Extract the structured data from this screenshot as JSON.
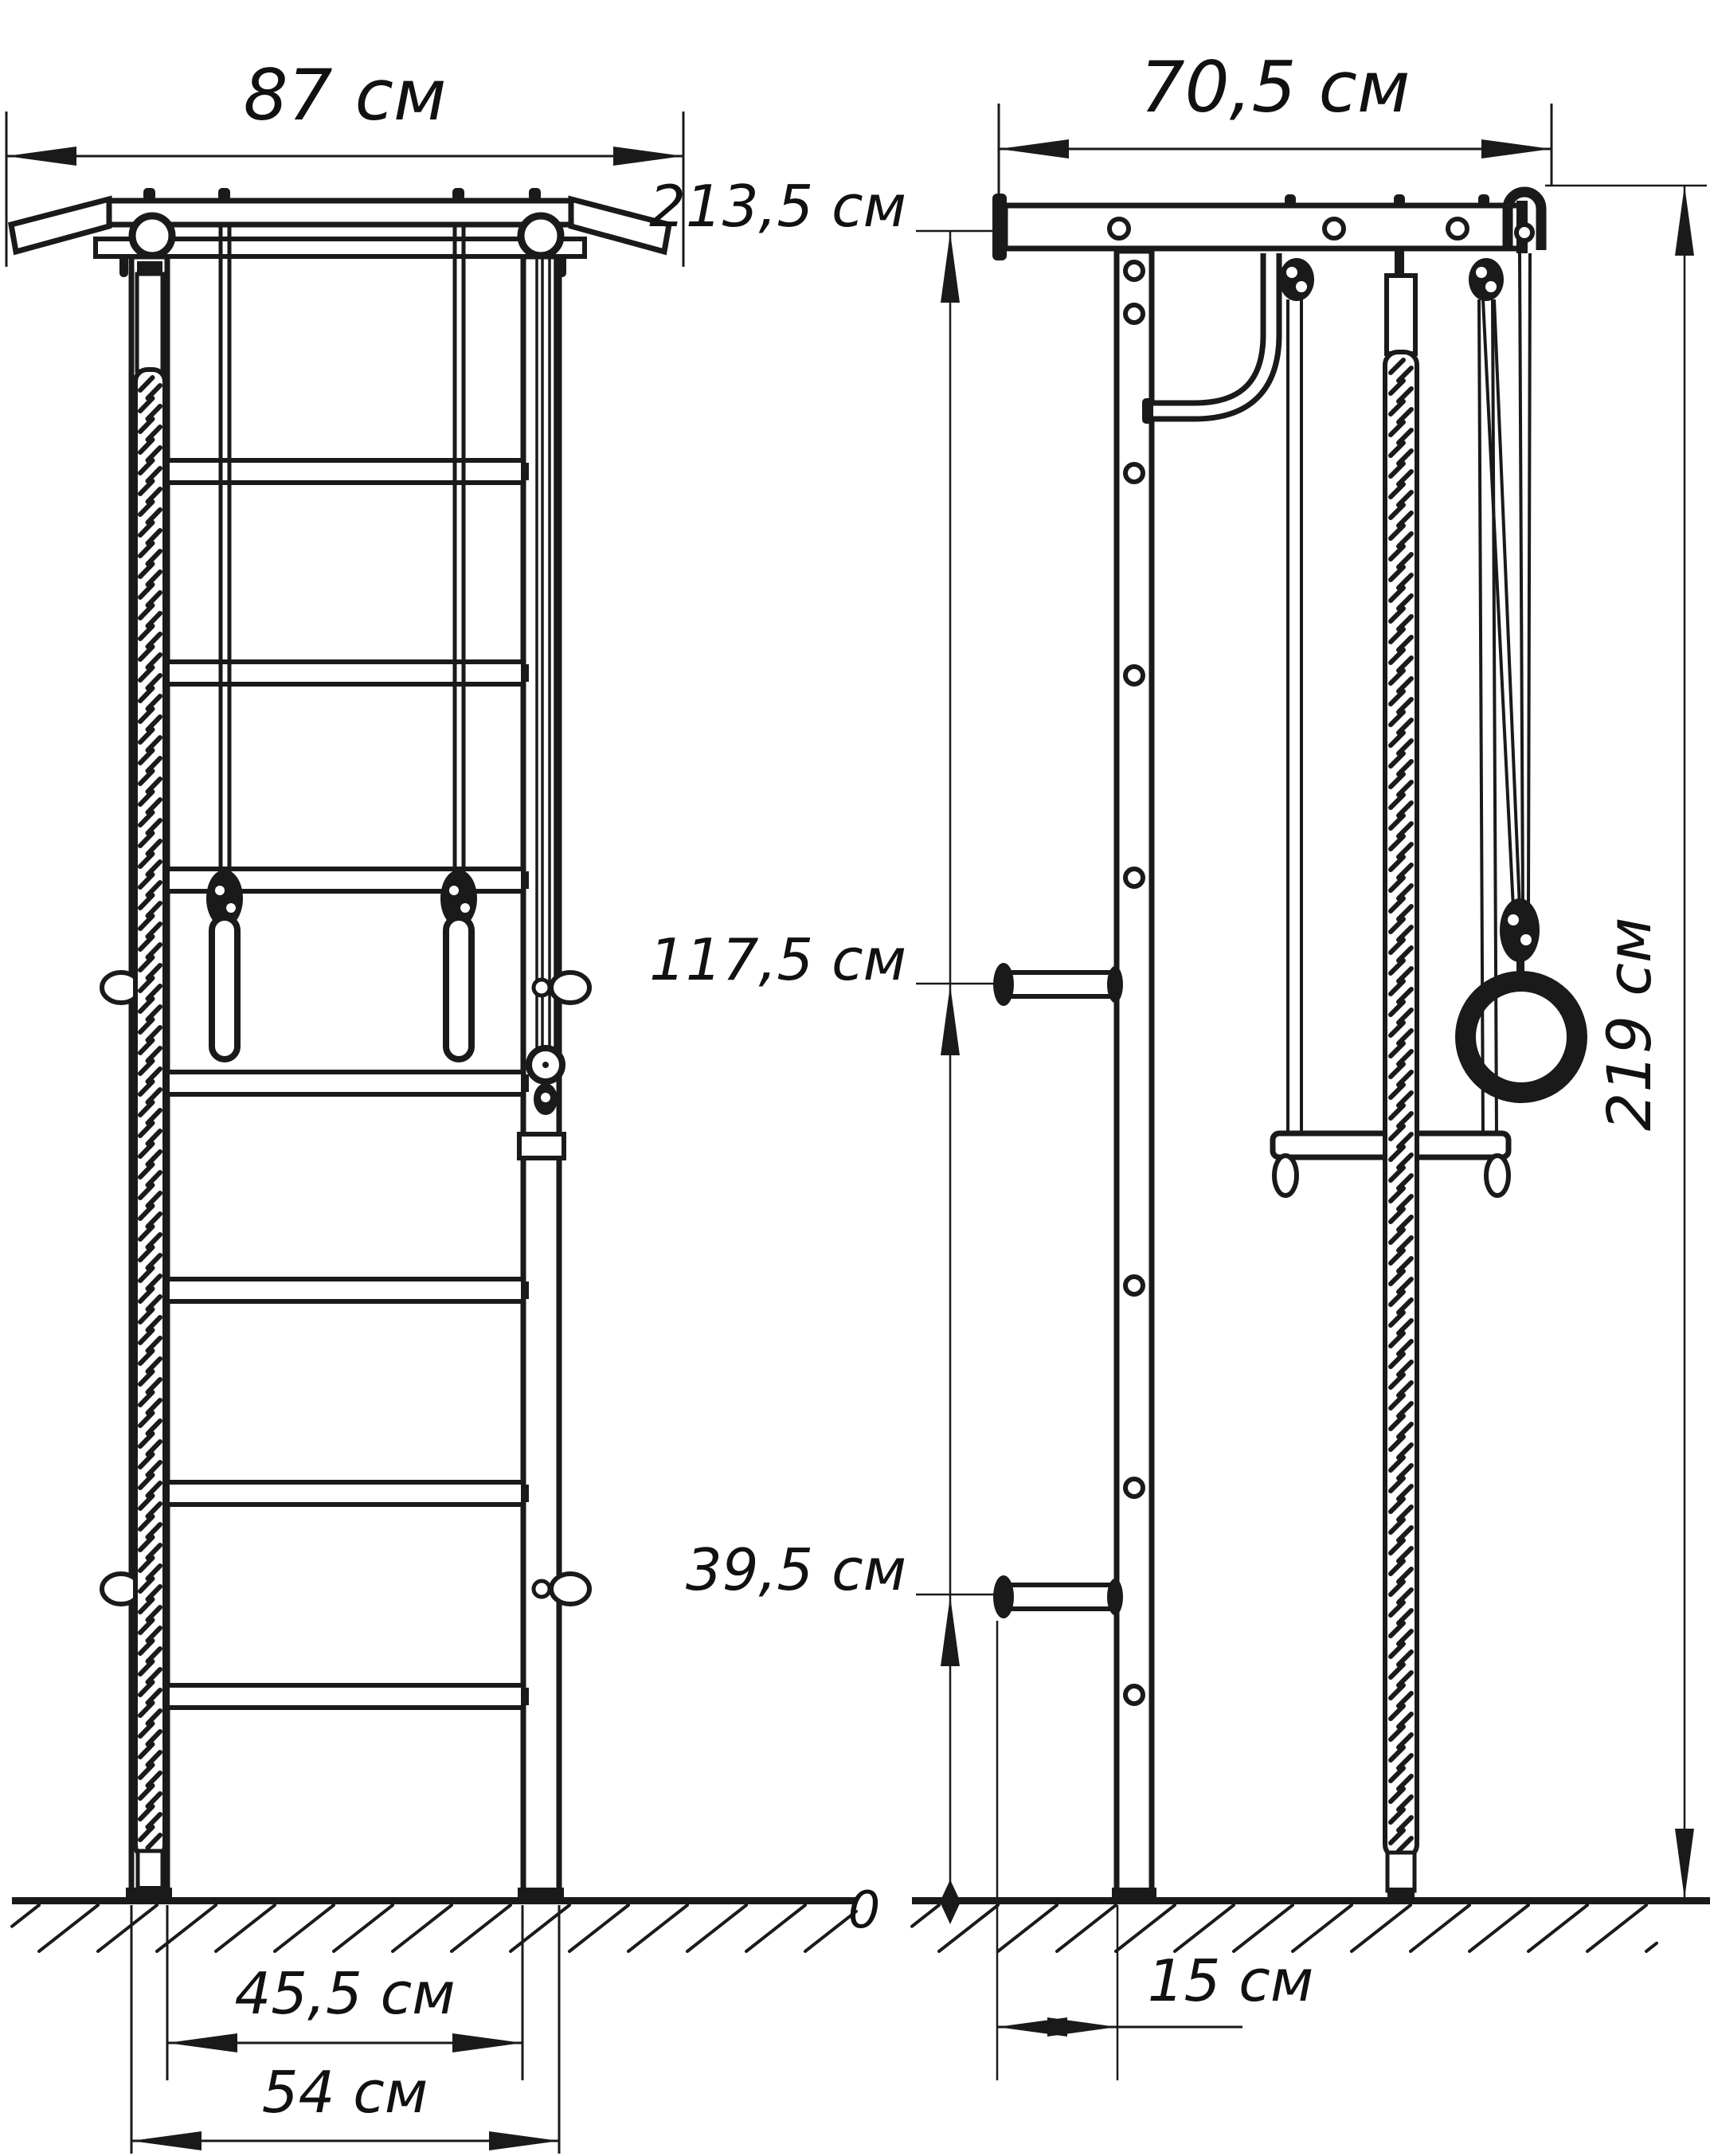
{
  "drawing": {
    "kind": "dimensional line drawing of wall-mounted gymnastics wall bars, front view and side view",
    "unit_suffix": "см",
    "labels": {
      "front_width_top": "87 см",
      "front_width_inner": "45,5 см",
      "front_width_outer": "54 см",
      "side_depth_top": "70,5 см",
      "side_height_beam": "213,5 см",
      "side_height_mid": "117,5 см",
      "side_height_low": "39,5 см",
      "side_height_total": "219 см",
      "side_wall_offset": "15 см",
      "ground_zero": "0"
    }
  }
}
